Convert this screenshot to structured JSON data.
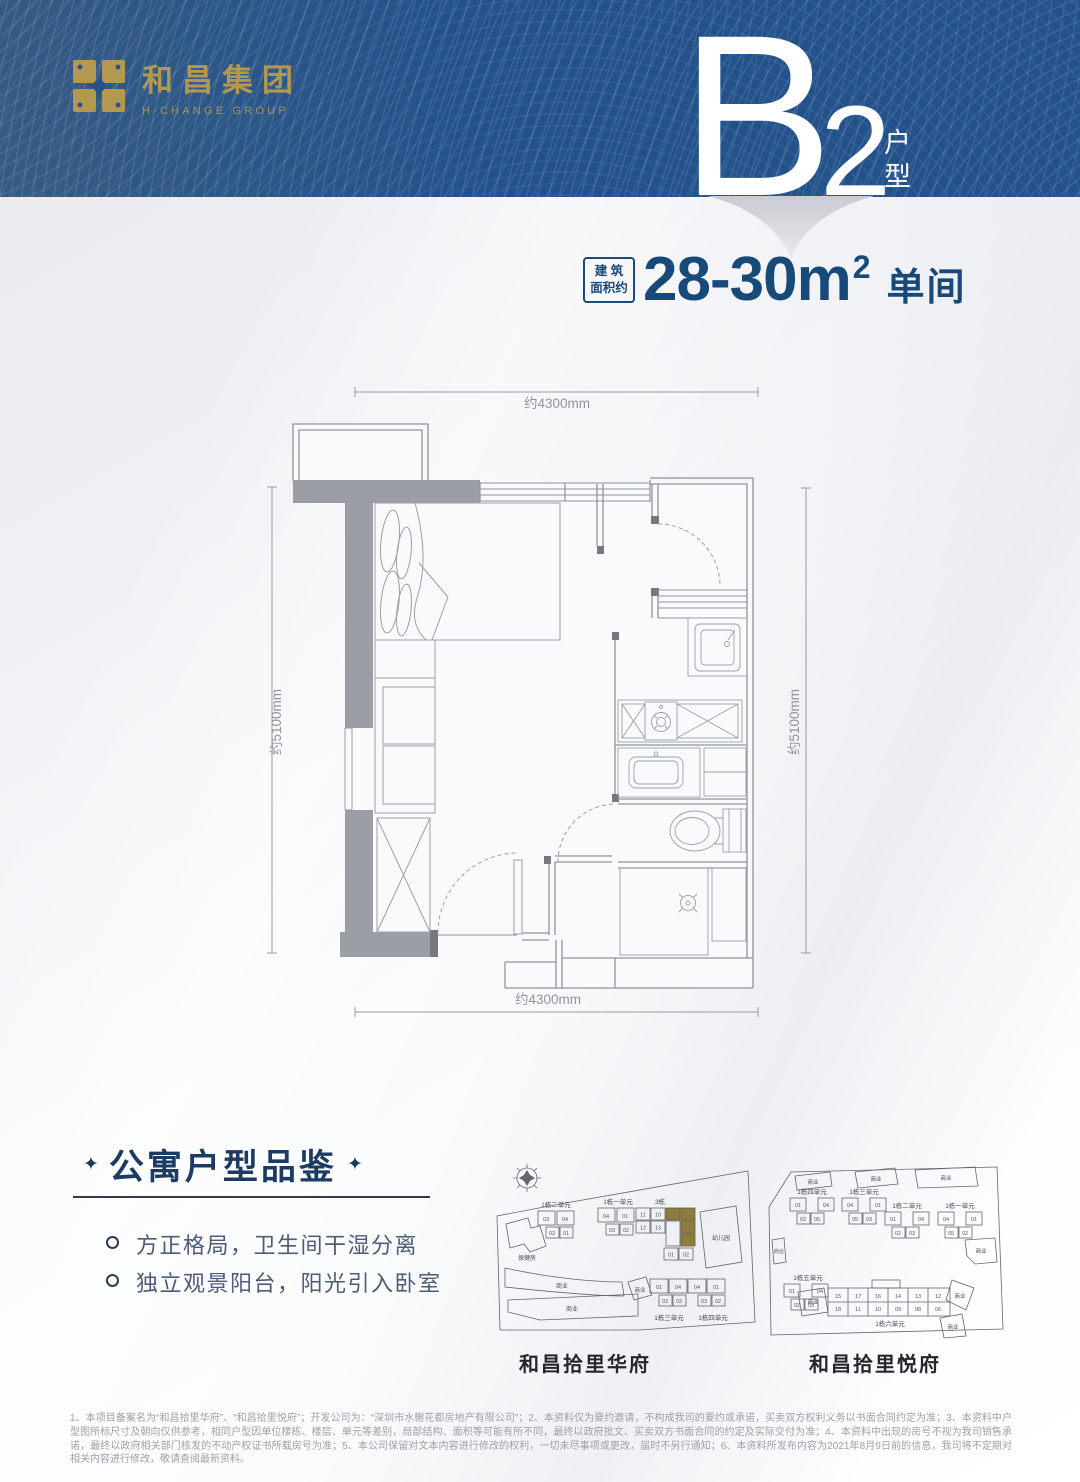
{
  "header": {
    "company_cn": "和昌集团",
    "company_en": "H-CHANGE GROUP",
    "unit_letter": "B",
    "unit_number": "2",
    "unit_suffix_top": "户",
    "unit_suffix_bottom": "型",
    "bg_color": "#23528a",
    "gold": "#b3984f"
  },
  "area": {
    "badge_line1": "建 筑",
    "badge_line2": "面积约",
    "value": "28-30m",
    "sup": "2",
    "room_type": "单间",
    "color": "#174a79"
  },
  "floorplan": {
    "dim_top": "约4300mm",
    "dim_bottom": "约4300mm",
    "dim_left": "约5100mm",
    "dim_right": "约5100mm"
  },
  "features": {
    "star": "✦",
    "title": "公寓户型品鉴",
    "items": [
      "方正格局，卫生间干湿分离",
      "独立观景阳台，阳光引入卧室"
    ]
  },
  "siteplans": {
    "biz_label": "商业",
    "left": {
      "caption": "和昌拾里华府",
      "labels": {
        "unit2": "1栋二单元",
        "unit1": "1栋一单元",
        "building3": "3栋",
        "kindergarten": "幼儿园",
        "clinic": "保健房",
        "unit3": "1栋三单元",
        "unit4": "1栋四单元"
      },
      "units": {
        "a": [
          "03",
          "04",
          "02",
          "01"
        ],
        "b": [
          "04",
          "01",
          "03",
          "02"
        ],
        "c": [
          "11",
          "10",
          "12",
          "13",
          "01",
          "02"
        ],
        "row": [
          "01",
          "04",
          "04",
          "01",
          "03",
          "02",
          "03",
          "02"
        ]
      },
      "highlight_color": "#8d7d42"
    },
    "right": {
      "caption": "和昌拾里悦府",
      "labels": {
        "unit4": "1栋四单元",
        "unit3": "1栋三单元",
        "unit2": "1栋二单元",
        "unit1": "1栋一单元",
        "unit5": "1栋五单元",
        "unit6": "1栋六单元"
      },
      "units": {
        "u4": [
          "01",
          "04",
          "02",
          "05"
        ],
        "u3": [
          "04",
          "01",
          "05",
          "03"
        ],
        "u2": [
          "01",
          "04",
          "02",
          "03"
        ],
        "u1": [
          "04",
          "01",
          "05",
          "02"
        ],
        "u5": [
          "01",
          "04",
          "02",
          "03"
        ],
        "u6_top": [
          "15",
          "17",
          "16",
          "14",
          "13",
          "12"
        ],
        "u6_bottom": [
          "18",
          "11",
          "10",
          "09",
          "08",
          "06"
        ]
      }
    }
  },
  "disclaimer": "1、本项目备案名为“和昌拾里华府”、“和昌拾里悦府”；开发公司为：“深圳市水榭花都房地产有限公司”；2、本资料仅为要约邀请，不构成我司的要约或承诺，买卖双方权利义务以书面合同约定为准；3、本资料中户型图所标尺寸及朝向仅供参考，相同户型因单位楼栋、楼层、单元等差别，局部结构、面积等可能有所不同，最终以政府批文、买卖双方书面合同的约定及实际交付为准；4、本资料中出现的房号不视为我司销售承诺，最终以政府相关部门核发的不动产权证书所载房号为准；5、本公司保留对文本内容进行修改的权利，一切未尽事项或更改，届时不另行通知；6、本资料所发布内容为2021年8月9日前的信息，我司将不定期对相关内容进行修改，敬请查阅最新资料。"
}
